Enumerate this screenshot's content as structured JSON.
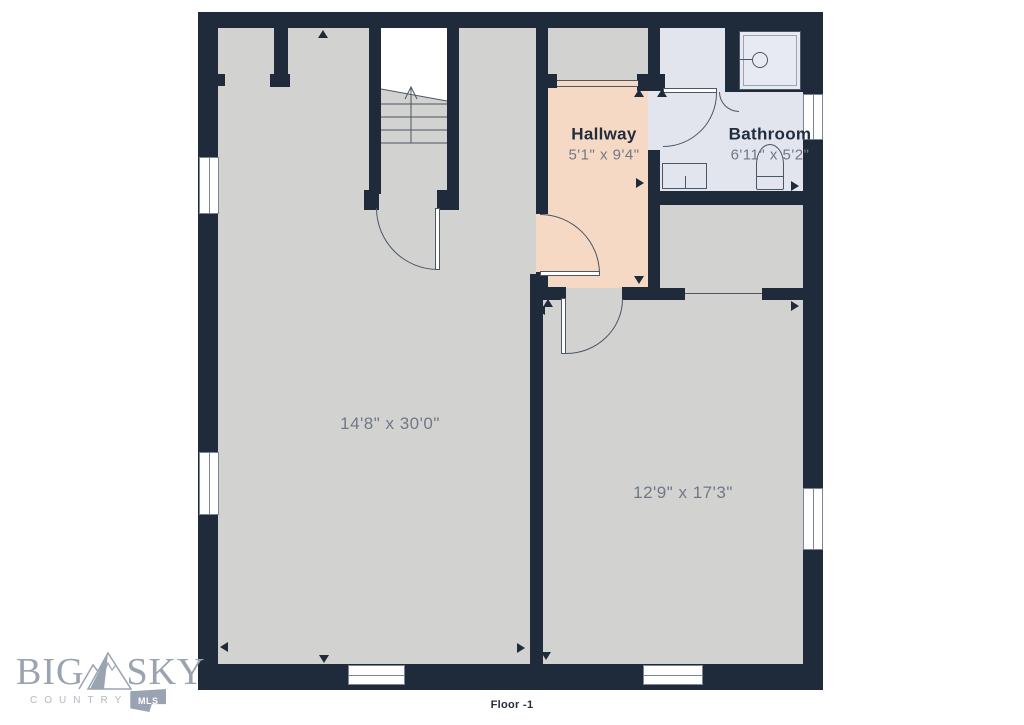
{
  "colors": {
    "wall": "#1f2b3a",
    "floor": "#d2d3d1",
    "hallway": "#f6d9c4",
    "bathroom": "#e2e5ee",
    "shower": "#e7eaf2",
    "line": "#4d5663",
    "label-text": "#222d3d",
    "dim-text": "#6f7888",
    "logo": "#9aa3b1",
    "logo-light": "#b2b8c2"
  },
  "floor_plan": {
    "floor_label": "Floor -1",
    "rooms": [
      {
        "name": "Hallway",
        "dimensions": "5'1\" x 9'4\""
      },
      {
        "name": "Bathroom",
        "dimensions": "6'11\" x 5'2\""
      },
      {
        "name": "",
        "dimensions": "14'8\" x 30'0\""
      },
      {
        "name": "",
        "dimensions": "12'9\" x 17'3\""
      }
    ]
  },
  "logo": {
    "word_left": "BIG",
    "word_right": "SKY",
    "subtitle": "COUNTRY",
    "badge": "MLS"
  }
}
